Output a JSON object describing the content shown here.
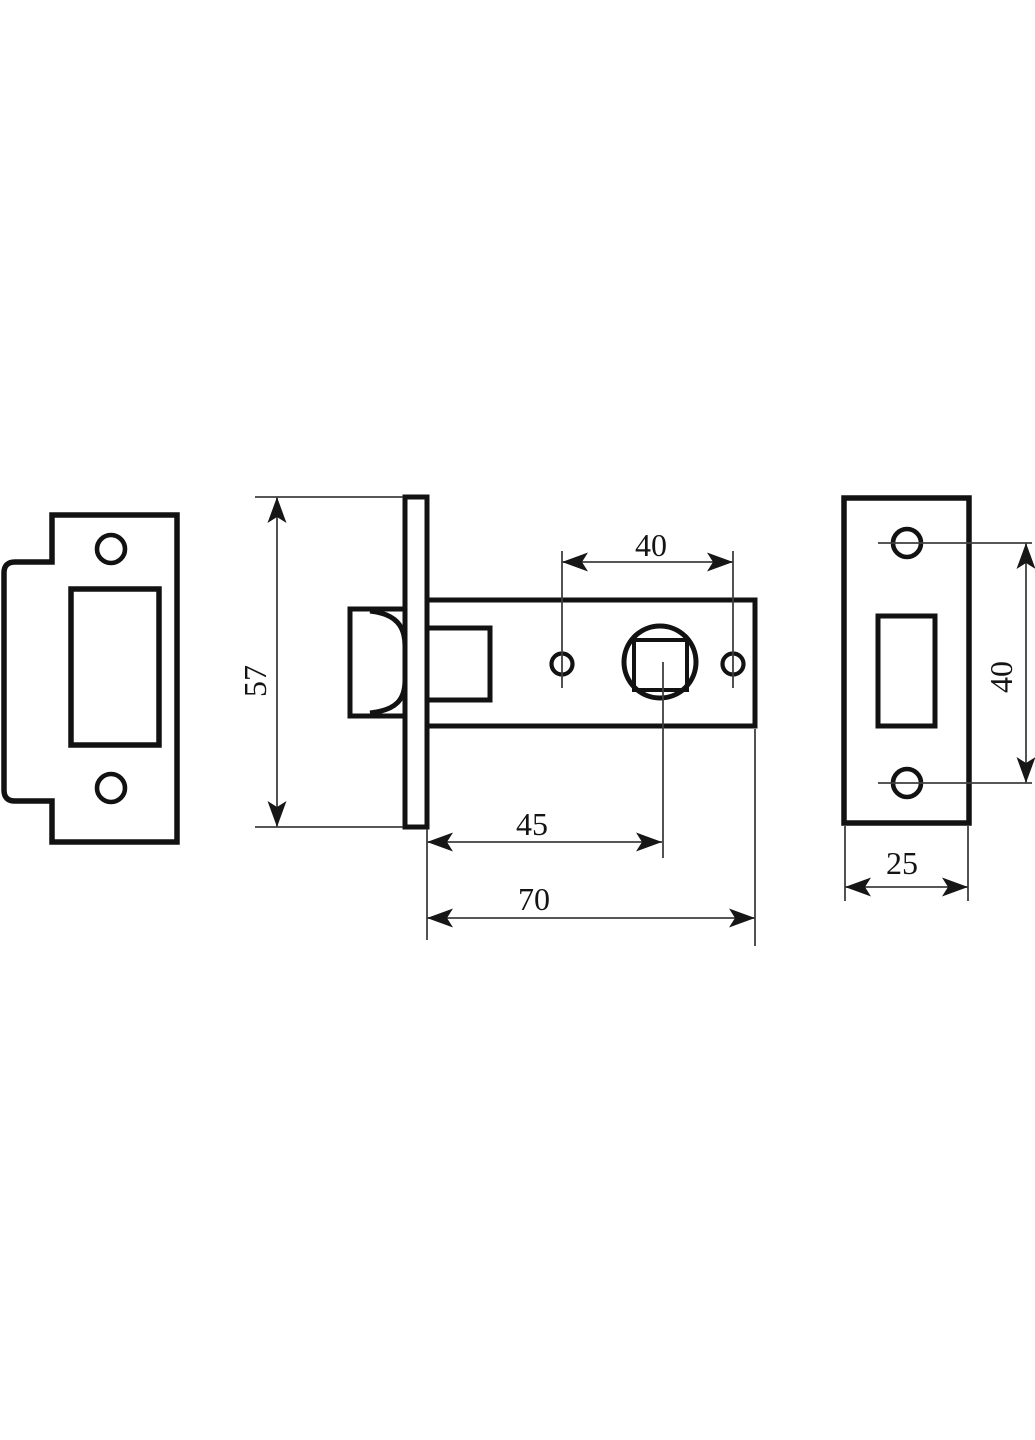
{
  "page": {
    "width": 1035,
    "height": 1440,
    "background": "#ffffff"
  },
  "drawing": {
    "title": "door-latch-technical-drawing",
    "style": {
      "outline_color": "#121212",
      "outline_width": 5,
      "thin_color": "#3f3f3f",
      "thin_width": 1.8,
      "arrow_color": "#161616",
      "label_color": "#141414",
      "label_font_size": 32,
      "background": "#ffffff"
    },
    "shapes": [
      {
        "id": "strike-plate-outline",
        "type": "path",
        "d": "M 52 515 L 177 515 L 177 842 L 52 842 L 52 801 L 15 801 Q 4 801 4 790 L 4 573 Q 4 562 15 562 L 52 562 Z",
        "fill": "#ffffff",
        "sw": 5.5
      },
      {
        "id": "strike-plate-screw-hole-top",
        "type": "circle",
        "cx": 111,
        "cy": 549,
        "r": 14,
        "sw": 4.6
      },
      {
        "id": "strike-plate-screw-hole-bottom",
        "type": "circle",
        "cx": 111,
        "cy": 788,
        "r": 14,
        "sw": 4.6
      },
      {
        "id": "strike-plate-latch-cutout",
        "type": "rect",
        "x": 71,
        "y": 589,
        "w": 88,
        "h": 156,
        "sw": 5.5
      },
      {
        "id": "latch-bolt",
        "type": "rect",
        "x": 350,
        "y": 609,
        "w": 56,
        "h": 107,
        "fill": "#ffffff",
        "sw": 5
      },
      {
        "id": "latch-bolt-bevel",
        "type": "path",
        "d": "M 370 611 C 396 614 405 626 405 646 L 405 680 C 405 700 396 710 370 713",
        "sw": 5
      },
      {
        "id": "latch-body",
        "type": "rect",
        "x": 426,
        "y": 600,
        "w": 329,
        "h": 126,
        "fill": "#ffffff",
        "sw": 5
      },
      {
        "id": "latch-bolt-tail",
        "type": "rect",
        "x": 426,
        "y": 628,
        "w": 64,
        "h": 72,
        "sw": 5
      },
      {
        "id": "latch-body-hole-left",
        "type": "circle",
        "cx": 562,
        "cy": 664,
        "r": 10.5,
        "sw": 4.2
      },
      {
        "id": "spindle-hub-circle",
        "type": "circle",
        "cx": 660,
        "cy": 662,
        "r": 36,
        "sw": 5
      },
      {
        "id": "spindle-square-hole",
        "type": "rect",
        "x": 634,
        "y": 640,
        "w": 53,
        "h": 50,
        "sw": 4
      },
      {
        "id": "latch-body-hole-right",
        "type": "circle",
        "cx": 733,
        "cy": 664,
        "r": 10.5,
        "sw": 4.2
      },
      {
        "id": "latch-faceplate-edge",
        "type": "rect",
        "x": 405,
        "y": 497,
        "w": 22,
        "h": 330,
        "fill": "#ffffff",
        "sw": 5
      },
      {
        "id": "faceplate-outline",
        "type": "rect",
        "x": 844,
        "y": 498,
        "w": 125,
        "h": 325,
        "fill": "#ffffff",
        "sw": 5.5
      },
      {
        "id": "faceplate-screw-hole-top",
        "type": "circle",
        "cx": 907,
        "cy": 543,
        "r": 14,
        "sw": 4.6
      },
      {
        "id": "faceplate-screw-hole-bottom",
        "type": "circle",
        "cx": 907,
        "cy": 783,
        "r": 14,
        "sw": 4.6
      },
      {
        "id": "faceplate-latch-cutout",
        "type": "rect",
        "x": 878,
        "y": 616,
        "w": 57,
        "h": 110,
        "sw": 5
      }
    ],
    "dimensions": [
      {
        "id": "dim-faceplate-height",
        "label": "57",
        "value": 57,
        "line": [
          277,
          497,
          277,
          827
        ],
        "arrows": [
          {
            "x": 277,
            "y": 497,
            "dir": "up"
          },
          {
            "x": 277,
            "y": 827,
            "dir": "down"
          }
        ],
        "extensions": [
          [
            255,
            497,
            403,
            497
          ],
          [
            255,
            827,
            403,
            827
          ]
        ],
        "label_anchor": {
          "x": 266,
          "y": 681,
          "rotate": -90
        }
      },
      {
        "id": "dim-hole-spacing",
        "label": "40",
        "value": 40,
        "line": [
          562,
          562,
          733,
          562
        ],
        "arrows": [
          {
            "x": 562,
            "y": 562,
            "dir": "left"
          },
          {
            "x": 733,
            "y": 562,
            "dir": "right"
          }
        ],
        "extensions": [
          [
            562,
            551,
            562,
            688
          ],
          [
            733,
            551,
            733,
            688
          ]
        ],
        "label_anchor": {
          "x": 651,
          "y": 556
        }
      },
      {
        "id": "dim-backset",
        "label": "45",
        "value": 45,
        "line": [
          427,
          842,
          662,
          842
        ],
        "arrows": [
          {
            "x": 427,
            "y": 842,
            "dir": "left"
          },
          {
            "x": 662,
            "y": 842,
            "dir": "right"
          }
        ],
        "extensions": [
          [
            663,
            662,
            663,
            858
          ]
        ],
        "label_anchor": {
          "x": 532,
          "y": 835
        }
      },
      {
        "id": "dim-body-length",
        "label": "70",
        "value": 70,
        "line": [
          427,
          918,
          755,
          918
        ],
        "arrows": [
          {
            "x": 427,
            "y": 918,
            "dir": "left"
          },
          {
            "x": 755,
            "y": 918,
            "dir": "right"
          }
        ],
        "extensions": [
          [
            427,
            829,
            427,
            940
          ],
          [
            755,
            729,
            755,
            946
          ]
        ],
        "label_anchor": {
          "x": 534,
          "y": 910
        }
      },
      {
        "id": "dim-faceplate-hole-spacing",
        "label": "40",
        "value": 40,
        "line": [
          1026,
          543,
          1026,
          783
        ],
        "arrows": [
          {
            "x": 1026,
            "y": 543,
            "dir": "up"
          },
          {
            "x": 1026,
            "y": 783,
            "dir": "down"
          }
        ],
        "extensions": [
          [
            878,
            543,
            1032,
            543
          ],
          [
            878,
            783,
            1032,
            783
          ]
        ],
        "label_anchor": {
          "x": 1012,
          "y": 677,
          "rotate": -90
        }
      },
      {
        "id": "dim-faceplate-width",
        "label": "25",
        "value": 25,
        "line": [
          845,
          887,
          968,
          887
        ],
        "arrows": [
          {
            "x": 845,
            "y": 887,
            "dir": "left"
          },
          {
            "x": 968,
            "y": 887,
            "dir": "right"
          }
        ],
        "extensions": [
          [
            845,
            826,
            845,
            901
          ],
          [
            968,
            826,
            968,
            901
          ]
        ],
        "label_anchor": {
          "x": 902,
          "y": 874
        }
      }
    ]
  }
}
